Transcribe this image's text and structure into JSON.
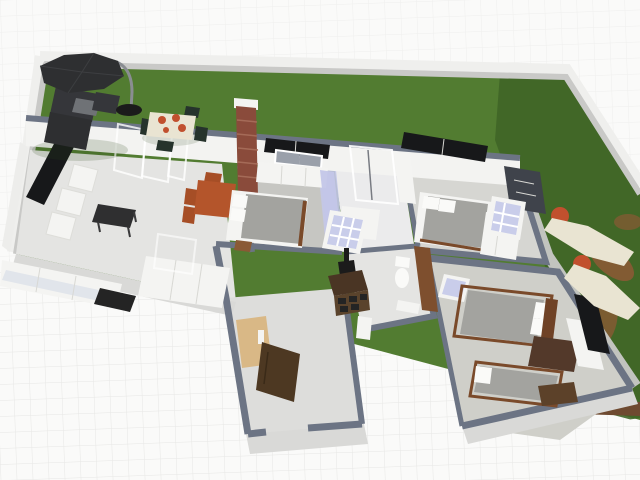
{
  "app": {
    "view_description": "3D perspective view of a single-storey house floor plan on a fenced lawn lot"
  },
  "palette": {
    "background": "#fafaf9",
    "grid_line": "#e6e6e4",
    "lawn_green": "#527c31",
    "lawn_green_dark": "#3f6527",
    "dirt_brown": "#8a5a35",
    "dirt_dark": "#6e4a30",
    "boundary_wall_face": "#efefed",
    "boundary_wall_top": "#c9c9c7",
    "wall_slate": "#6c7484",
    "wall_face_white": "#f3f3f1",
    "wall_face_shadow": "#d9d9d7",
    "wall_face_west": "#ededeb",
    "path_concrete": "#c9c9c7",
    "floor_light": "#e4e4e2",
    "floor_plank": "#c6c6c2",
    "floor_mid": "#d6d6d2",
    "floor_hall": "#dddddb",
    "floor_bath": "#ebebec",
    "floor_se": "#cfcfc9",
    "floor_lavender": "#c3c6e8",
    "glass_pane": "#e3eae2",
    "window_black": "#17181a",
    "window_pane_dark": "#9aa0aa",
    "lattice_lavender": "#c9cdea",
    "accent_wall_dark": "#3f434b",
    "brick_red": "#8a4b3b",
    "brick_mortar": "#a56b58",
    "furniture_white": "#f4f4f2",
    "furniture_black": "#2f2f30",
    "piano_black": "#242424",
    "mattress_gray": "#a3a39f",
    "pillow_white": "#fafaf8",
    "bedframe_brown": "#7a4a2a",
    "headboard_brown": "#6f4226",
    "wood_dark": "#4a3524",
    "wood_mid": "#5a432c",
    "desk_brown": "#53392a",
    "cabinet_brown": "#5c4129",
    "vanity_brown": "#7e4f2e",
    "sideboard_tan": "#d9b886",
    "door_brown": "#4d3822",
    "table_orange": "#b4552b",
    "chair_orange": "#a64e26",
    "chair_dark_green": "#26332c",
    "lounger_cream": "#e9e4d2",
    "towel_orange": "#c1502e",
    "umbrella_dark": "#2e2f31",
    "pole_gray": "#8a8d92",
    "outdoor_sofa_dark": "#35363a",
    "outdoor_table_gray": "#6f7276",
    "grill_black": "#1b1b1b",
    "shower_glass": "#585b61",
    "sofa_cushion_blue": "#dde2ea",
    "shadow_green": "#2c4a1e"
  },
  "scene": {
    "ground": "white canvas with faint square grid",
    "lot": "rectangular lawn bounded by low white garden wall on north, west and east",
    "objects": [
      {
        "id": "patio-umbrella",
        "label": "cantilever patio umbrella",
        "area": "garden NW"
      },
      {
        "id": "outdoor-sofa-set",
        "label": "dark outdoor lounge set",
        "area": "garden NW"
      },
      {
        "id": "garden-table",
        "label": "garden dining table with chairs",
        "area": "garden N"
      },
      {
        "id": "folding-glass-doors",
        "label": "open folding glass patio doors",
        "area": "living room N wall"
      },
      {
        "id": "brick-chimney",
        "label": "brick chimney",
        "area": "house N"
      },
      {
        "id": "living-tv",
        "label": "black TV panel",
        "area": "living room NW"
      },
      {
        "id": "sofa-modules",
        "label": "white armchair modules",
        "area": "living room W"
      },
      {
        "id": "long-sofa",
        "label": "long white sofa",
        "area": "living room S"
      },
      {
        "id": "piano",
        "label": "black piano/desk",
        "area": "living room S"
      },
      {
        "id": "coffee-table",
        "label": "dark coffee table",
        "area": "living room center"
      },
      {
        "id": "corner-unit",
        "label": "white corner sofa unit",
        "area": "living room SE"
      },
      {
        "id": "display-case",
        "label": "glass display case",
        "area": "living room E"
      },
      {
        "id": "dining-table",
        "label": "orange dining table with chairs",
        "area": "dining area"
      },
      {
        "id": "master-bed",
        "label": "double bed, gray mattress",
        "area": "master bedroom"
      },
      {
        "id": "wardrobe",
        "label": "white wardrobe",
        "area": "master bedroom N"
      },
      {
        "id": "mirror-strip",
        "label": "lavender mirrored wardrobe",
        "area": "hallway"
      },
      {
        "id": "shower-cabin",
        "label": "glass shower cabin",
        "area": "bathroom"
      },
      {
        "id": "bath-sink",
        "label": "white washbasin cabinet",
        "area": "bathroom"
      },
      {
        "id": "toilet",
        "label": "toilet with cistern",
        "area": "WC"
      },
      {
        "id": "vanity",
        "label": "brown vanity cabinet",
        "area": "WC"
      },
      {
        "id": "grill-table",
        "label": "barbecue grill table",
        "area": "center hall"
      },
      {
        "id": "east-bed",
        "label": "double bed",
        "area": "east bedroom"
      },
      {
        "id": "accent-wall",
        "label": "dark patterned accent wall",
        "area": "east bedroom"
      },
      {
        "id": "se-double-bed",
        "label": "double bed with brown frame",
        "area": "SE bedroom"
      },
      {
        "id": "se-single-bed",
        "label": "single bed with brown frame",
        "area": "SE bedroom"
      },
      {
        "id": "se-desk",
        "label": "dark desk",
        "area": "SE bedroom"
      },
      {
        "id": "se-tv",
        "label": "black TV on white dresser",
        "area": "SE bedroom E wall"
      },
      {
        "id": "entry-sideboard",
        "label": "light wood sideboard",
        "area": "entry hall"
      },
      {
        "id": "entry-door",
        "label": "open brown entry door",
        "area": "entry S wall"
      },
      {
        "id": "pedestal",
        "label": "white pedestal",
        "area": "entry hall"
      },
      {
        "id": "chaise-lounge-1",
        "label": "cream chaise lounge with orange towel",
        "area": "east lawn"
      },
      {
        "id": "chaise-lounge-2",
        "label": "cream chaise lounge with orange towel",
        "area": "east lawn"
      },
      {
        "id": "dirt-patches",
        "label": "bare soil patches",
        "area": "east lawn"
      }
    ]
  }
}
